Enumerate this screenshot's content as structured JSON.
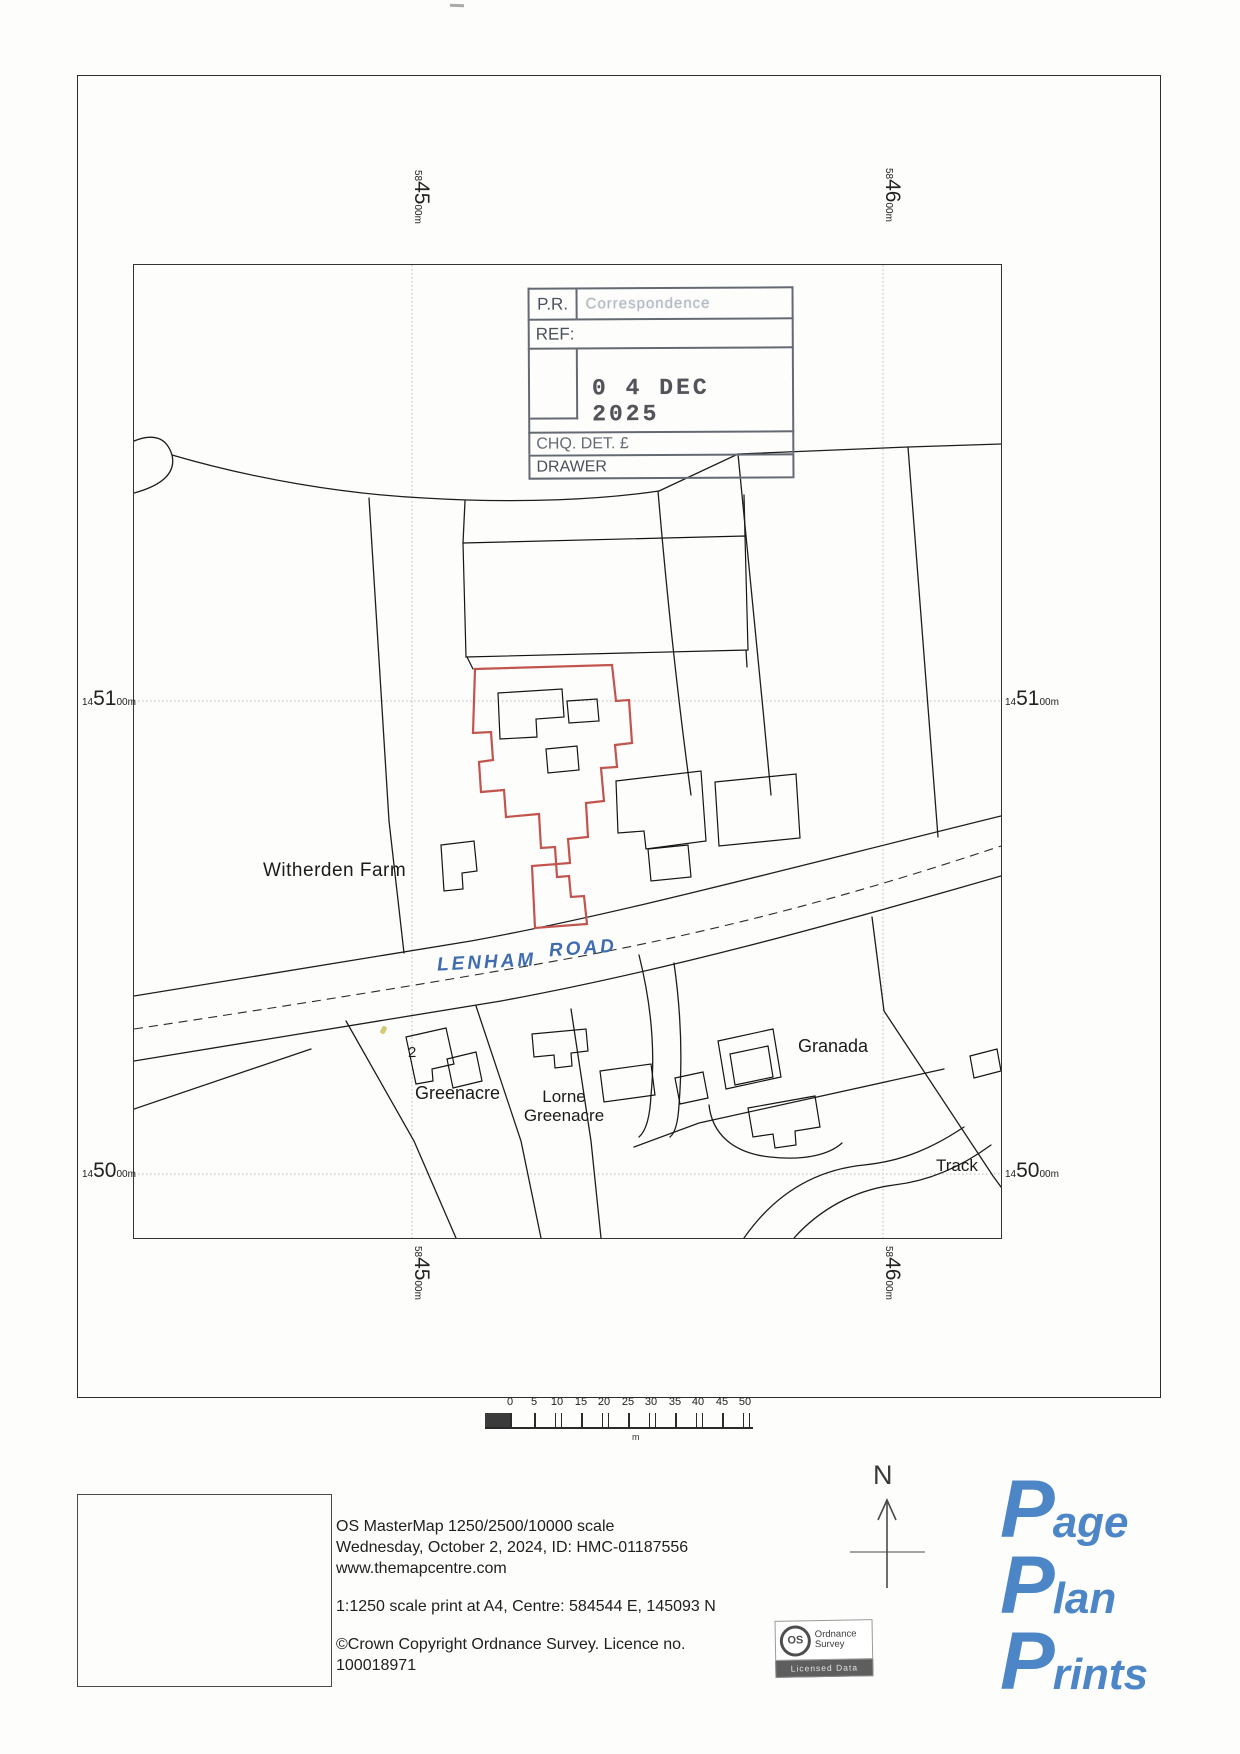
{
  "stamp": {
    "pr_label": "P.R.",
    "pr_value": "Correspondence",
    "ref_label": "REF:",
    "date": "0 4 DEC 2025",
    "chq_label": "CHQ. DET. £",
    "drawer_label": "DRAWER"
  },
  "grid": {
    "eastings": [
      {
        "prefix": "58",
        "main": "45",
        "suffix": "00m"
      },
      {
        "prefix": "58",
        "main": "46",
        "suffix": "00m"
      }
    ],
    "northings": [
      {
        "prefix": "14",
        "main": "51",
        "suffix": "00m"
      },
      {
        "prefix": "14",
        "main": "50",
        "suffix": "00m"
      }
    ]
  },
  "map_labels": {
    "farm": "Witherden Farm",
    "road_word1": "LENHAM",
    "road_word2": "ROAD",
    "plot_number": "2",
    "greenacre": "Greenacre",
    "lorne_line1": "Lorne",
    "lorne_line2": "Greenacre",
    "granada": "Granada",
    "track": "Track"
  },
  "scale_bar": {
    "ticks": [
      "0",
      "5",
      "10",
      "15",
      "20",
      "25",
      "30",
      "35",
      "40",
      "45",
      "50"
    ],
    "unit": "m"
  },
  "north": {
    "label": "N"
  },
  "footer": {
    "product": "OS MasterMap 1250/2500/10000 scale",
    "date_id": "Wednesday, October 2, 2024, ID: HMC-01187556",
    "website": "www.themapcentre.com",
    "print_info": "1:1250 scale print at A4, Centre: 584544 E, 145093 N",
    "copyright": "©Crown Copyright Ordnance Survey. Licence no.",
    "licence_number": "100018971"
  },
  "os_badge": {
    "monogram": "OS",
    "name1": "Ordnance",
    "name2": "Survey",
    "banner": "Licensed Data"
  },
  "brand_logo": {
    "line1_initial": "P",
    "line1_rest": "age",
    "line2_initial": "P",
    "line2_rest": "lan",
    "line3_initial": "P",
    "line3_rest": "rints"
  },
  "colors": {
    "plot_boundary_red": "#c2544e",
    "handwriting_blue": "#3f6cb0",
    "logo_blue": "#4d86c6"
  }
}
